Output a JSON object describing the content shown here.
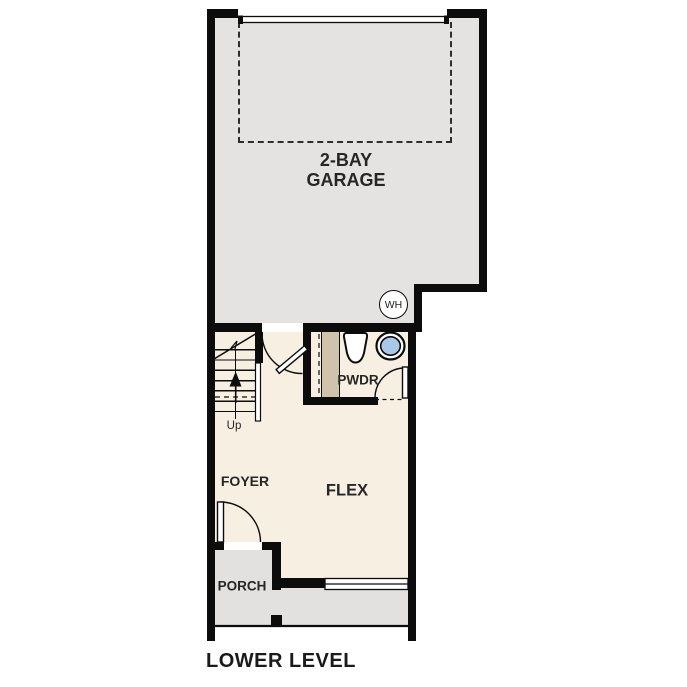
{
  "plan": {
    "title": "LOWER LEVEL",
    "rooms": {
      "garage": {
        "name_line1": "2-BAY",
        "name_line2": "GARAGE"
      },
      "powder": {
        "name": "PWDR"
      },
      "foyer": {
        "name": "FOYER"
      },
      "flex": {
        "name": "FLEX"
      },
      "porch": {
        "name": "PORCH"
      }
    },
    "stairs": {
      "direction_label": "Up"
    },
    "fixtures": {
      "water_heater_label": "WH"
    }
  },
  "colors": {
    "wall": "#0c0c0c",
    "garage_floor": "#e4e3e1",
    "porch_floor": "#e2e1df",
    "interior_floor": "#f7f0e2",
    "plumbing_wall": "#cfc4ab",
    "sink_basin": "#a9c8e9",
    "label_text": "#262626",
    "background": "#ffffff"
  }
}
